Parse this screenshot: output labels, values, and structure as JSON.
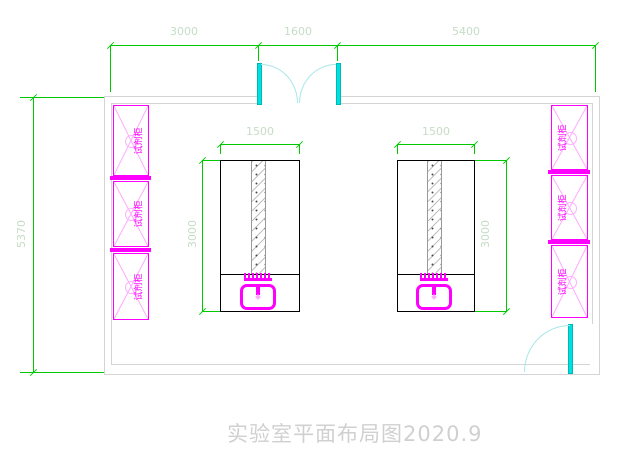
{
  "drawing": {
    "title": "实验室平面布局图2020.9",
    "dims": {
      "top_left": "3000",
      "top_middle": "1600",
      "top_right": "5400",
      "left_height": "5370",
      "bench_width": "1500",
      "bench_depth": "3000"
    },
    "cabinet_label": "试剂柜",
    "colors": {
      "dimension_line": "#00c800",
      "dimension_text": "#c6dcc6",
      "furniture_magenta": "#ff00ff",
      "furniture_light_pink": "#ffaaff",
      "door_cyan": "#00e0e0",
      "wall_gray": "#d4d4d4",
      "bench_outline": "#000000",
      "title_gray": "#d0d0d0"
    }
  }
}
